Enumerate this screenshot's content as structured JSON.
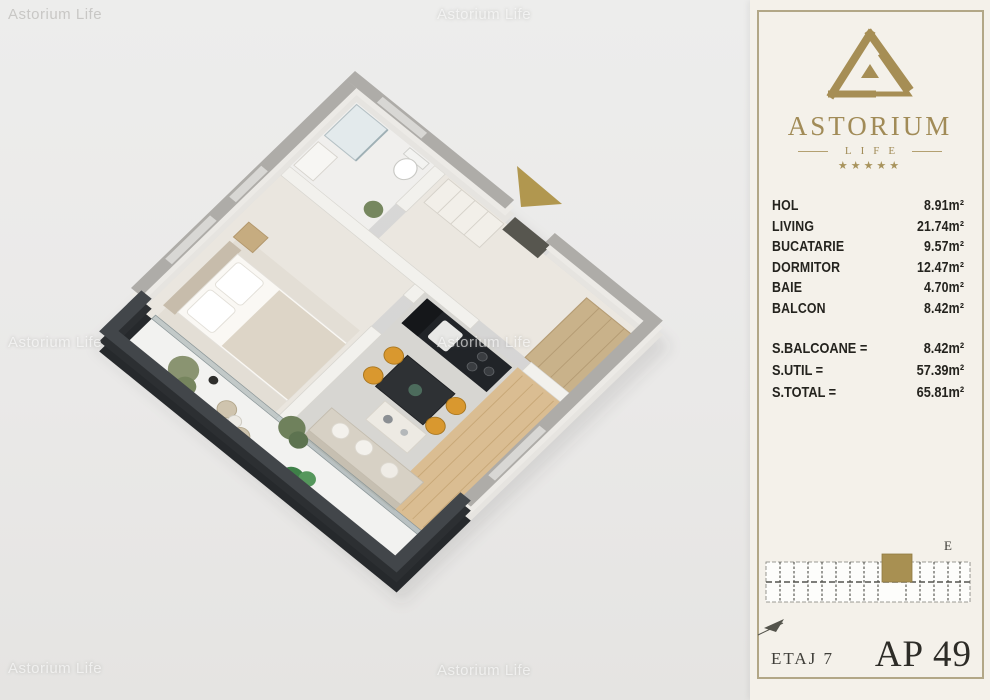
{
  "watermark": "Astorium Life",
  "brand": {
    "name": "ASTORIUM",
    "sub": "LIFE",
    "stars": "★★★★★"
  },
  "panel": {
    "rooms": [
      {
        "label": "HOL",
        "value": "8.91m²"
      },
      {
        "label": "LIVING",
        "value": "21.74m²"
      },
      {
        "label": "BUCATARIE",
        "value": "9.57m²"
      },
      {
        "label": "DORMITOR",
        "value": "12.47m²"
      },
      {
        "label": "BAIE",
        "value": "4.70m²"
      },
      {
        "label": "BALCON",
        "value": "8.42m²"
      }
    ],
    "totals": [
      {
        "label": "S.BALCOANE =",
        "value": "8.42m²"
      },
      {
        "label": "S.UTIL =",
        "value": "57.39m²"
      },
      {
        "label": "S.TOTAL =",
        "value": "65.81m²"
      }
    ],
    "site_plan": {
      "section_label": "E"
    },
    "floor_label": "ETAJ 7",
    "apartment_label": "AP 49"
  },
  "colors": {
    "gold": "#a9914f",
    "panel_border": "#b2a787",
    "wall_top": "#aeaca8",
    "parapet": "#26292c",
    "chair_orange": "#d9982f"
  }
}
